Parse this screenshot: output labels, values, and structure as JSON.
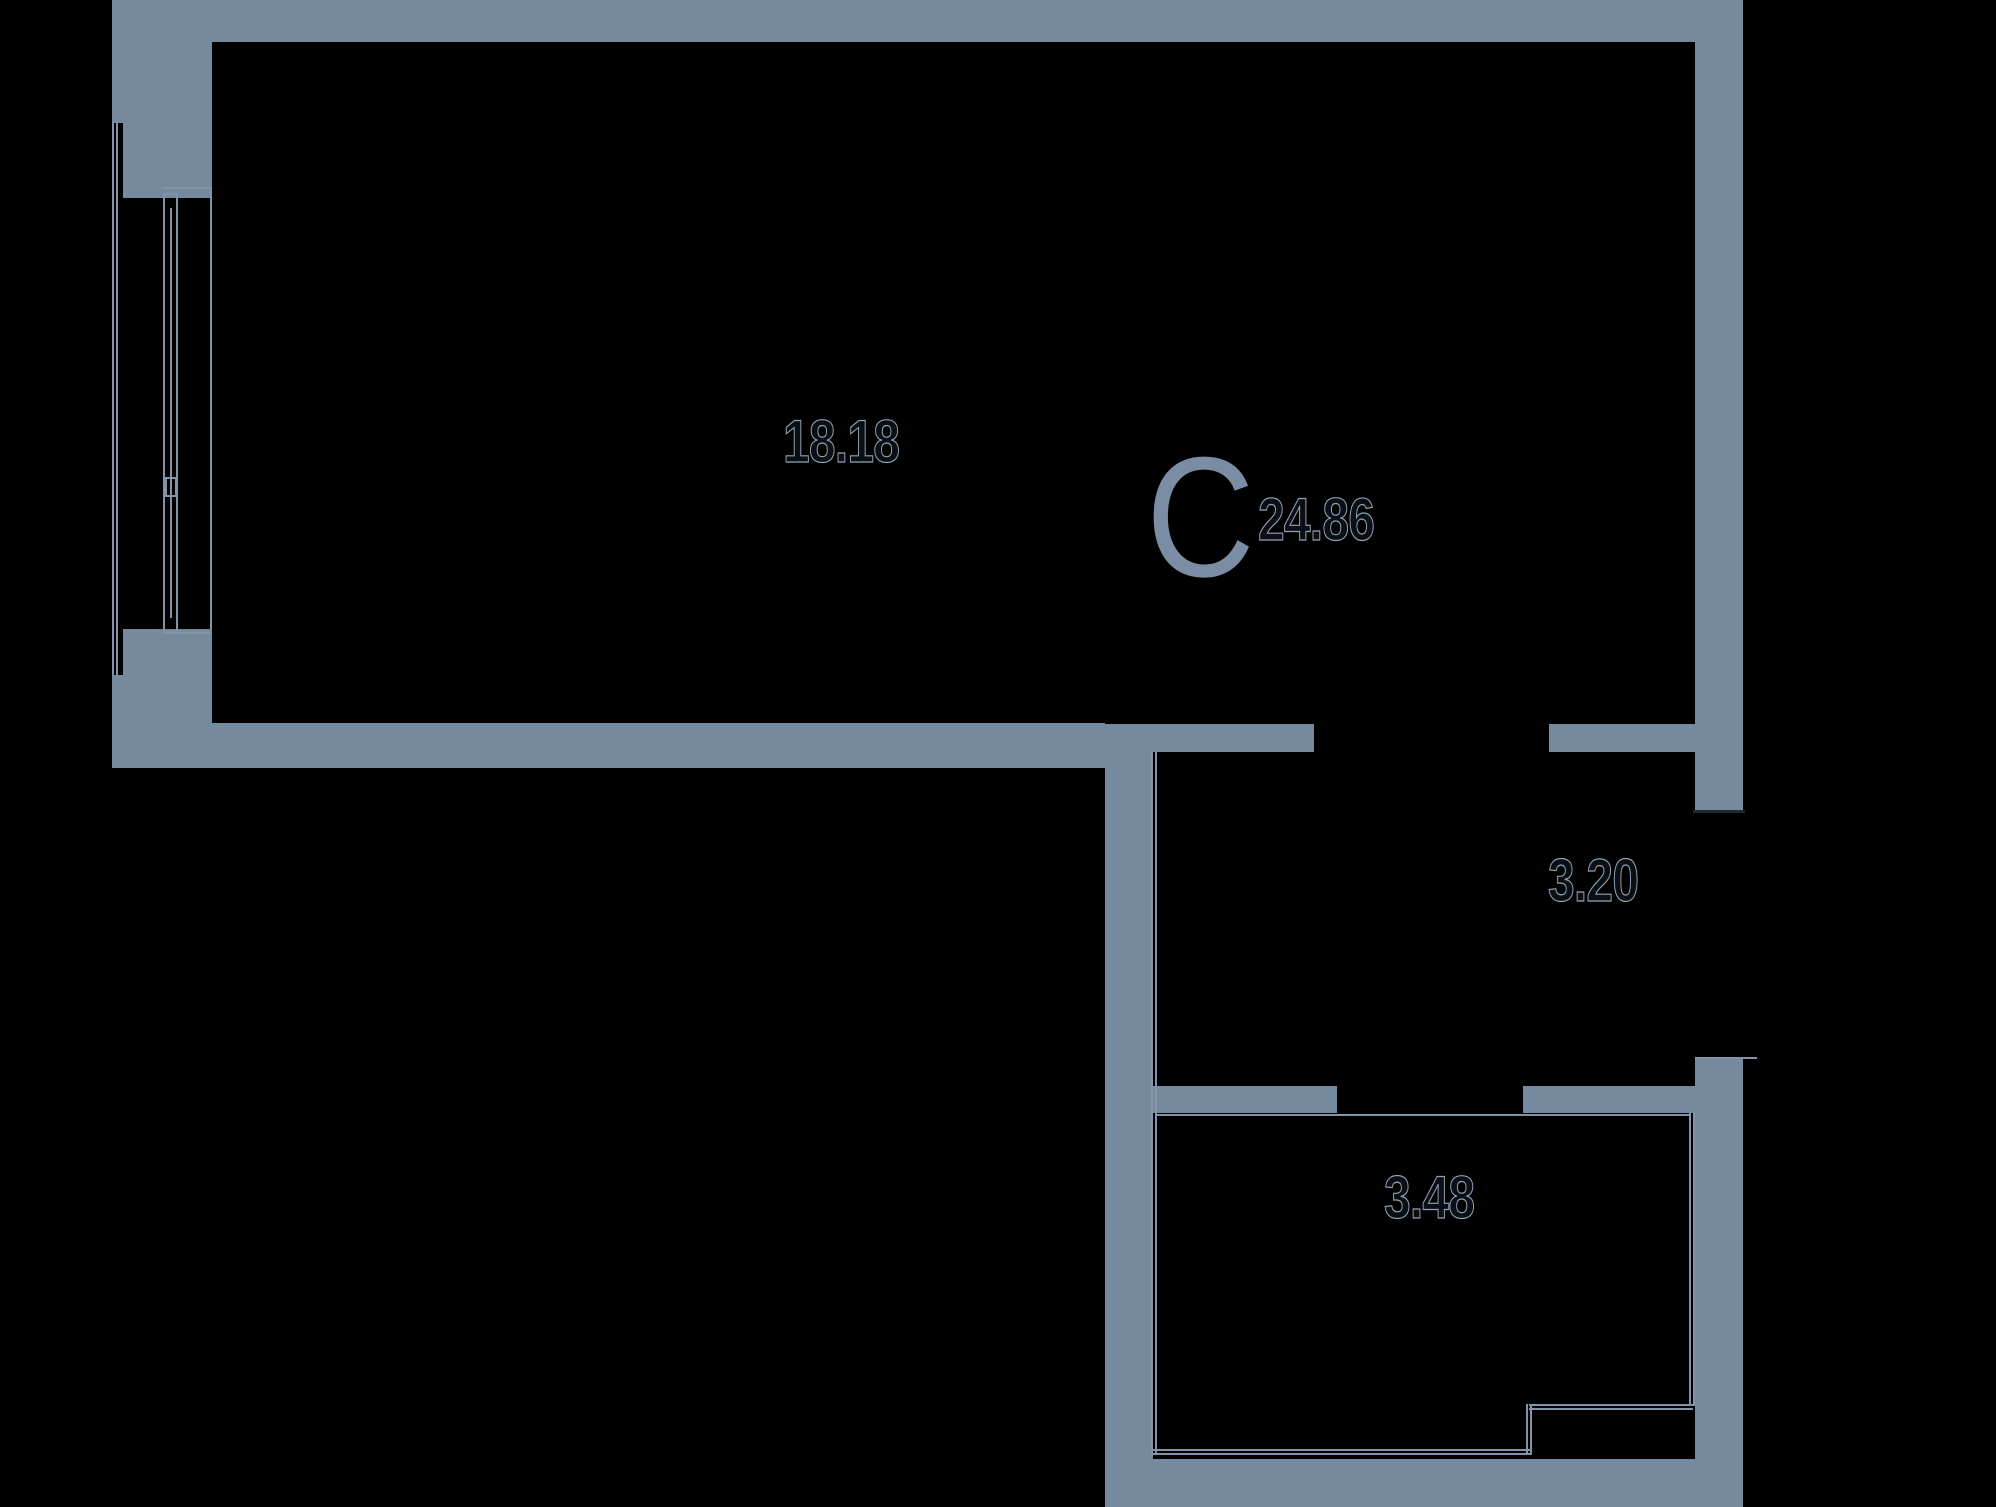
{
  "floorplan": {
    "background_color": "#000000",
    "wall_color": "#75899F",
    "thin_line_color": "#8494A8",
    "unit_marker": {
      "letter": "C",
      "total_area": "24.86",
      "letter_color": "#7B8DA4"
    },
    "room_areas": {
      "living": "18.18",
      "hallway": "3.20",
      "bathroom": "3.48"
    },
    "label_style": {
      "fill": "#0A0F15",
      "outline": "#94A1B2"
    }
  }
}
